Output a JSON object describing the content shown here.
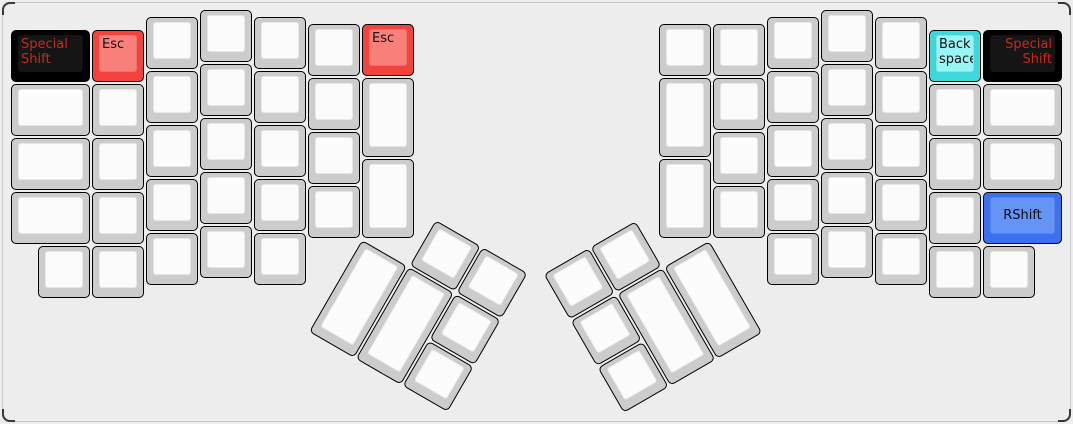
{
  "canvas": {
    "width": 1073,
    "height": 424,
    "background": "#ededed",
    "case_border": "#c9c9c9",
    "corner_accent": "#3a3a3a"
  },
  "key_styles": {
    "default": {
      "side": "#cccccc",
      "top": "#fbfbfb",
      "text": "#141414"
    },
    "dark": {
      "side": "#000000",
      "top": "#151515",
      "text": "#c8281e"
    },
    "red": {
      "side": "#f4433c",
      "top": "#f8807a",
      "text": "#111111"
    },
    "cyan": {
      "side": "#3ed8da",
      "top": "#99f4f4",
      "text": "#111111"
    },
    "blue": {
      "side": "#3b70f0",
      "top": "#6494f5",
      "text": "#0b0b0b"
    }
  },
  "keyboard": {
    "unit_px": 54,
    "halves": [
      {
        "name": "left-half",
        "origin_px": [
          11,
          10
        ],
        "keys": [
          {
            "x": 0,
            "y": 0.375,
            "w": 1.5,
            "style": "dark",
            "label": "Special\nShift",
            "align": "tl",
            "name": "key-special-shift-left"
          },
          {
            "x": 0,
            "y": 1.375,
            "w": 1.5
          },
          {
            "x": 0,
            "y": 2.375,
            "w": 1.5
          },
          {
            "x": 0,
            "y": 3.375,
            "w": 1.5
          },
          {
            "x": 1.5,
            "y": 0.375,
            "style": "red",
            "label": "Esc",
            "align": "tl",
            "name": "key-esc-left"
          },
          {
            "x": 1.5,
            "y": 1.375
          },
          {
            "x": 1.5,
            "y": 2.375
          },
          {
            "x": 1.5,
            "y": 3.375
          },
          {
            "x": 2.5,
            "y": 0.125
          },
          {
            "x": 2.5,
            "y": 1.125
          },
          {
            "x": 2.5,
            "y": 2.125
          },
          {
            "x": 2.5,
            "y": 3.125
          },
          {
            "x": 3.5,
            "y": 0
          },
          {
            "x": 3.5,
            "y": 1
          },
          {
            "x": 3.5,
            "y": 2
          },
          {
            "x": 3.5,
            "y": 3
          },
          {
            "x": 4.5,
            "y": 0.125
          },
          {
            "x": 4.5,
            "y": 1.125
          },
          {
            "x": 4.5,
            "y": 2.125
          },
          {
            "x": 4.5,
            "y": 3.125
          },
          {
            "x": 5.5,
            "y": 0.25
          },
          {
            "x": 5.5,
            "y": 1.25
          },
          {
            "x": 5.5,
            "y": 2.25
          },
          {
            "x": 5.5,
            "y": 3.25
          },
          {
            "x": 6.5,
            "y": 0.25,
            "style": "red",
            "label": "Esc",
            "align": "tl",
            "name": "key-esc-left-inner"
          },
          {
            "x": 6.5,
            "y": 1.25,
            "h": 1.5
          },
          {
            "x": 6.5,
            "y": 2.75,
            "h": 1.5
          },
          {
            "x": 0.5,
            "y": 4.375
          },
          {
            "x": 1.5,
            "y": 4.375
          },
          {
            "x": 2.5,
            "y": 4.125
          },
          {
            "x": 3.5,
            "y": 4.0
          },
          {
            "x": 4.5,
            "y": 4.125
          }
        ]
      },
      {
        "name": "right-half",
        "origin_px": [
          659,
          10
        ],
        "keys": [
          {
            "x": 0,
            "y": 0.25
          },
          {
            "x": 0,
            "y": 1.25,
            "h": 1.5
          },
          {
            "x": 0,
            "y": 2.75,
            "h": 1.5
          },
          {
            "x": 1,
            "y": 0.25
          },
          {
            "x": 1,
            "y": 1.25
          },
          {
            "x": 1,
            "y": 2.25
          },
          {
            "x": 1,
            "y": 3.25
          },
          {
            "x": 2,
            "y": 0.125
          },
          {
            "x": 2,
            "y": 1.125
          },
          {
            "x": 2,
            "y": 2.125
          },
          {
            "x": 2,
            "y": 3.125
          },
          {
            "x": 3,
            "y": 0
          },
          {
            "x": 3,
            "y": 1
          },
          {
            "x": 3,
            "y": 2
          },
          {
            "x": 3,
            "y": 3
          },
          {
            "x": 4,
            "y": 0.125
          },
          {
            "x": 4,
            "y": 1.125
          },
          {
            "x": 4,
            "y": 2.125
          },
          {
            "x": 4,
            "y": 3.125
          },
          {
            "x": 5,
            "y": 0.375,
            "style": "cyan",
            "label": "Back\nspace",
            "align": "tl",
            "name": "key-backspace"
          },
          {
            "x": 5,
            "y": 1.375
          },
          {
            "x": 5,
            "y": 2.375
          },
          {
            "x": 5,
            "y": 3.375
          },
          {
            "x": 6,
            "y": 0.375,
            "w": 1.5,
            "style": "dark",
            "label": "Special\nShift",
            "align": "tr",
            "name": "key-special-shift-right"
          },
          {
            "x": 6,
            "y": 1.375,
            "w": 1.5
          },
          {
            "x": 6,
            "y": 2.375,
            "w": 1.5
          },
          {
            "x": 6,
            "y": 3.375,
            "w": 1.5,
            "style": "blue",
            "label": "RShift",
            "align": "center",
            "name": "key-rshift"
          },
          {
            "x": 2,
            "y": 4.125
          },
          {
            "x": 3,
            "y": 4.0
          },
          {
            "x": 4,
            "y": 4.125
          },
          {
            "x": 5,
            "y": 4.375
          },
          {
            "x": 6,
            "y": 4.375
          }
        ]
      }
    ],
    "thumb_clusters": [
      {
        "name": "left-thumb-cluster",
        "origin_px": [
          362,
          239.5
        ],
        "rotation_deg": 30,
        "keys": [
          {
            "x": 1,
            "y": -1
          },
          {
            "x": 2,
            "y": -1
          },
          {
            "x": 0,
            "y": 0,
            "h": 2
          },
          {
            "x": 1,
            "y": 0,
            "h": 2
          },
          {
            "x": 2,
            "y": 0
          },
          {
            "x": 2,
            "y": 1
          }
        ]
      },
      {
        "name": "right-thumb-cluster",
        "origin_px": [
          711,
          239.5
        ],
        "rotation_deg": -30,
        "keys": [
          {
            "x": -3,
            "y": -1
          },
          {
            "x": -2,
            "y": -1
          },
          {
            "x": -2,
            "y": 0,
            "h": 2
          },
          {
            "x": -1,
            "y": 0,
            "h": 2
          },
          {
            "x": -3,
            "y": 0
          },
          {
            "x": -3,
            "y": 1
          }
        ]
      }
    ]
  }
}
